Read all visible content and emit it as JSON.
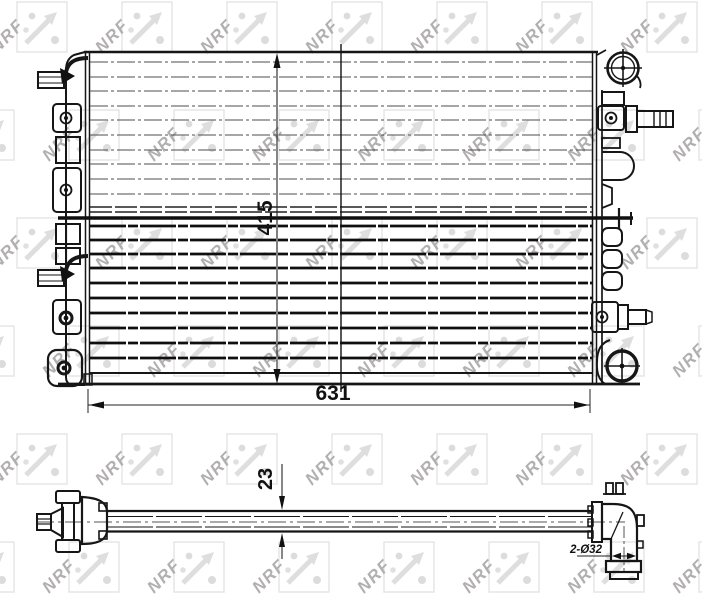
{
  "watermark": {
    "text": "NRF"
  },
  "views": {
    "front": {
      "dim_height_label": "415",
      "dim_width_label": "631"
    },
    "side": {
      "dim_thickness_label": "23",
      "dim_ports_label": "2-Ø32"
    }
  },
  "colors": {
    "background": "#ffffff",
    "line_dark": "#161616",
    "line_gray": "#4d4d4d",
    "watermark_light": "#dedede",
    "watermark_dark": "#b2afaf"
  }
}
